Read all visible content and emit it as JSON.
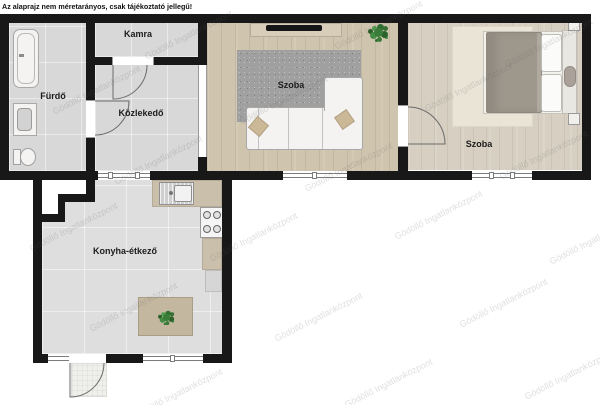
{
  "disclaimer": "Az alaprajz nem méretarányos, csak tájékoztató jellegű!",
  "watermark": {
    "text": "Gödöllő Ingatlanközpont"
  },
  "rooms": [
    {
      "id": "furdo",
      "label": "Fürdő"
    },
    {
      "id": "kamra",
      "label": "Kamra"
    },
    {
      "id": "kozlekedo",
      "label": "Közlekedő"
    },
    {
      "id": "szoba-nappali",
      "label": "Szoba"
    },
    {
      "id": "szoba-halo",
      "label": "Szoba"
    },
    {
      "id": "konyha-etkezo",
      "label": "Konyha-étkező"
    }
  ],
  "colors": {
    "wall": "#181818",
    "tile_floor": "#d8d8d8",
    "wood_floor": "#cfc4ae",
    "wood_floor_light": "#d7cfc2",
    "rug_gray": "#a0a0a0",
    "rug_cream": "#eae4d7",
    "counter_beige": "#cabfab",
    "plant_green": "#3a7c3a"
  }
}
